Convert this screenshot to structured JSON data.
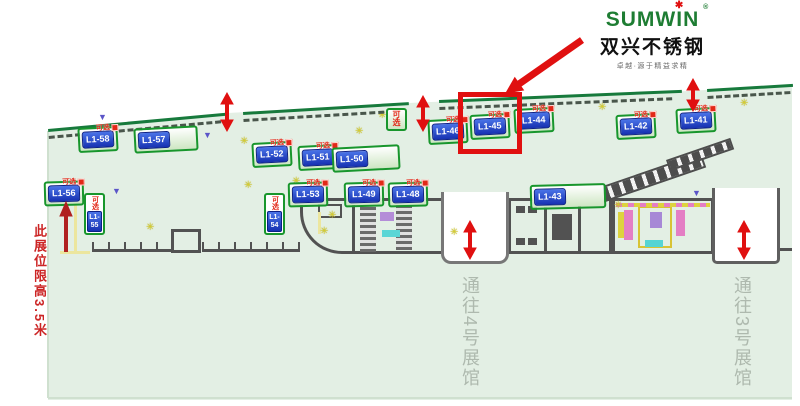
{
  "logo": {
    "brand": "SUMWIN",
    "reg": "®",
    "star": "✱",
    "title_cn": "双兴不锈钢",
    "tagline": "卓越·源于精益求精"
  },
  "annotations": {
    "height_note": "此展位限高3.5米"
  },
  "passages": {
    "hall4_label": "通往4号展馆",
    "hall3_label": "通往3号展馆"
  },
  "booths": [
    {
      "label": "L1-58",
      "tag": "可选"
    },
    {
      "label": "L1-57"
    },
    {
      "label": "L1-56",
      "tag": "可选"
    },
    {
      "label": "L1-55",
      "tag": "可选"
    },
    {
      "label": "L1-54",
      "tag": "可选"
    },
    {
      "label": "L1-53",
      "tag": "可选"
    },
    {
      "label": "L1-52",
      "tag": "可选"
    },
    {
      "label": "L1-51",
      "tag": "可选"
    },
    {
      "label": "L1-50"
    },
    {
      "label": "L1-49",
      "tag": "可选"
    },
    {
      "label": "L1-48",
      "tag": "可选"
    },
    {
      "tag": "可选"
    },
    {
      "label": "L1-46",
      "tag": "可选"
    },
    {
      "label": "L1-45",
      "tag": "可选",
      "highlighted": true
    },
    {
      "label": "L1-44",
      "tag": "可选"
    },
    {
      "label": "L1-43"
    },
    {
      "label": "L1-42",
      "tag": "可选"
    },
    {
      "label": "L1-41",
      "tag": "可选"
    }
  ],
  "icons": {
    "caution": "✳",
    "marker_triangle": "▼"
  },
  "colors": {
    "accent_red": "#e01010",
    "booth_blue": "#1d3fc0",
    "label_green": "#18962c",
    "map_mint": "#e3efe4",
    "boundary_green": "#177a3c",
    "structure_gray": "#525252",
    "caution_yellow": "#d6ce2e",
    "triangle_purple": "#5b55c8",
    "passage_text_gray": "#aeb9ae",
    "note_red": "#cc2525",
    "logo_green": "#1e7d33"
  }
}
